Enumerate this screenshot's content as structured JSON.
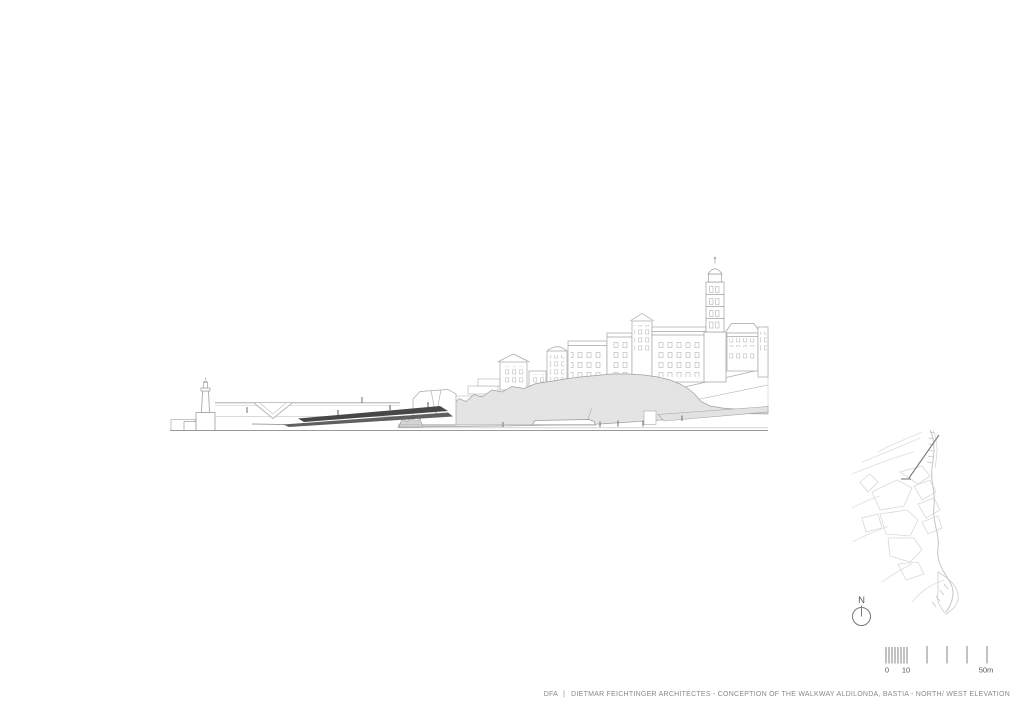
{
  "footer": {
    "firm": "DFA",
    "divider": "|",
    "title": "DIETMAR FEICHTINGER ARCHITECTES - CONCEPTION OF THE WALKWAY ALDILONDA, BASTIA - NORTH/ WEST ELEVATION"
  },
  "north_arrow": {
    "label": "N"
  },
  "scale_bar": {
    "labels": {
      "zero": "0",
      "ten": "10",
      "fifty": "50m"
    }
  },
  "drawing": {
    "type": "architectural-elevation",
    "elements": [
      "lighthouse",
      "harbor-jetty",
      "aldilonda-walkway",
      "rock-cliff",
      "citadel-buildings",
      "bell-tower",
      "quay",
      "boat",
      "pedestrian-figures"
    ]
  },
  "site_map": {
    "elements": [
      "city-plan",
      "coastline",
      "view-direction-arrow"
    ]
  },
  "colors": {
    "line": "#9c9c9c",
    "light_fill": "#e4e4e4",
    "walkway_dark": "#4a4a4a",
    "map_line": "#d8d8d8",
    "text": "#8a8a8a"
  }
}
